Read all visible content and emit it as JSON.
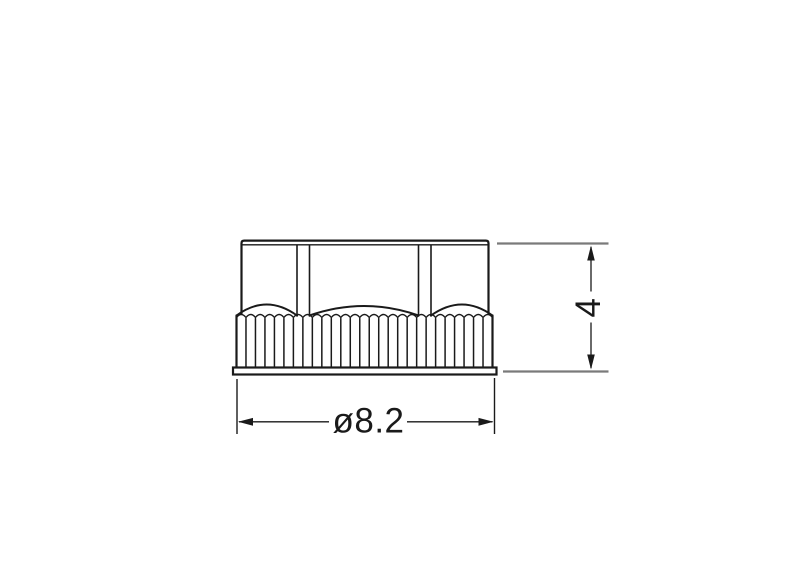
{
  "drawing": {
    "dimensions": {
      "diameter": "ø8.2",
      "height": "4"
    },
    "colors": {
      "line": "#1a1a1a",
      "extension": "#7a7a7a",
      "background": "#ffffff"
    }
  }
}
